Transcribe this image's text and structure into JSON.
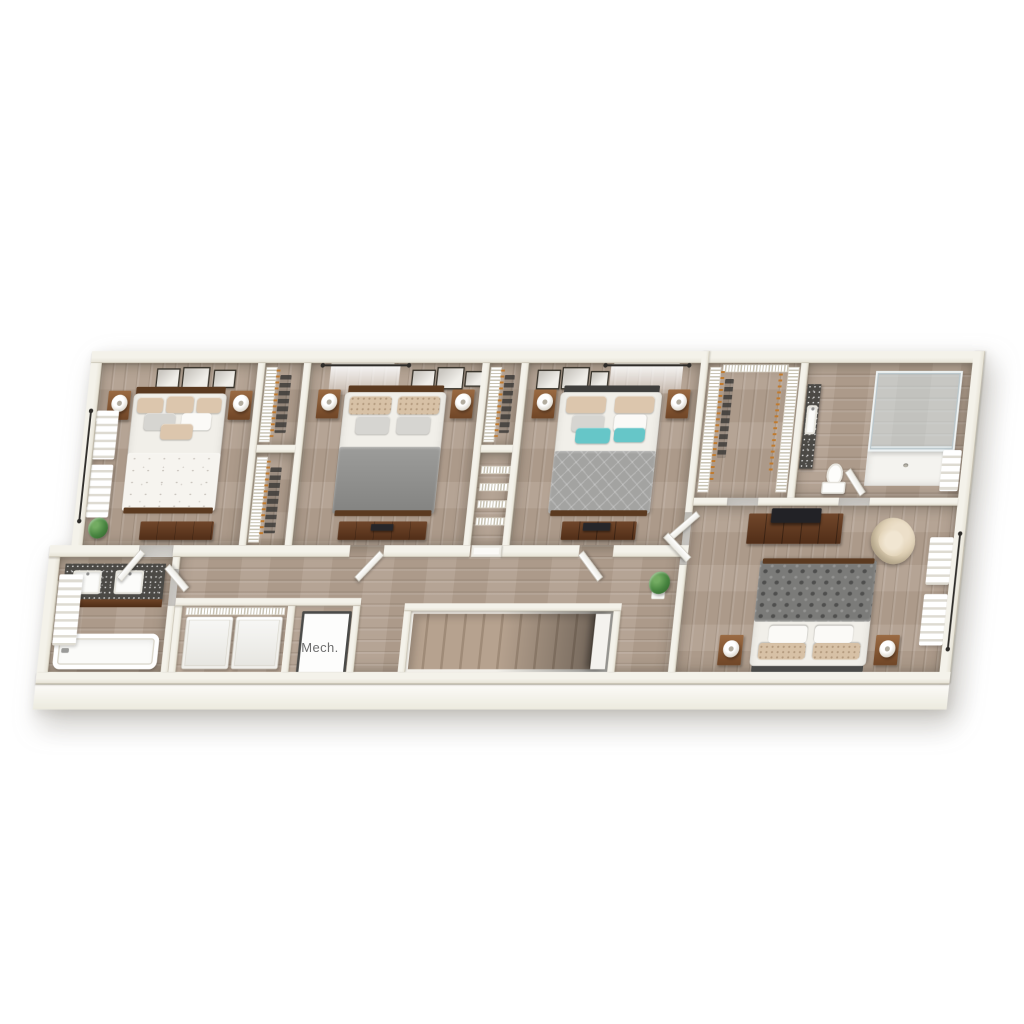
{
  "scene": {
    "type": "3d-floorplan-render",
    "view": "tilted top-down dollhouse",
    "background": "#ffffff"
  },
  "labels": {
    "mech": "Mech."
  },
  "palette": {
    "wall_top": "#f4f2ea",
    "wall": "#e6e2d5",
    "wall_edge": "#c8c2b2",
    "floor": "#b19f8f",
    "wood_dark": "#5b3a20",
    "wood_mid": "#8a5a36",
    "granite": "#4b4945",
    "teal": "#66c6c8",
    "gray_blanket": "#909090",
    "appliance": "#f6f6f3",
    "glass": "#d9e6ea",
    "hanger": "#c07a2e",
    "plant": "#47833f",
    "label": "#6e6e6e"
  },
  "rooms": [
    {
      "name": "bedroom-1",
      "furniture": [
        "bed-floral",
        "nightstand",
        "nightstand",
        "table-lamp",
        "table-lamp",
        "dresser",
        "gallery-frames",
        "window",
        "curtains",
        "potted-plant"
      ]
    },
    {
      "name": "closet-a-upper",
      "furniture": [
        "wire-shelving",
        "clothes-hangers",
        "hanging-clothes"
      ]
    },
    {
      "name": "closet-a-lower",
      "furniture": [
        "wire-shelving",
        "clothes-hangers",
        "hanging-clothes"
      ]
    },
    {
      "name": "bedroom-2",
      "furniture": [
        "bed-gray",
        "nightstand",
        "nightstand",
        "table-lamp",
        "table-lamp",
        "dresser",
        "gallery-frames",
        "window",
        "sheer-curtain",
        "curtain-rod"
      ]
    },
    {
      "name": "closet-b-upper",
      "furniture": [
        "wire-shelving",
        "clothes-hangers",
        "hanging-clothes"
      ]
    },
    {
      "name": "linen-closet",
      "furniture": [
        "wire-shelves",
        "door"
      ]
    },
    {
      "name": "bedroom-3",
      "furniture": [
        "bed-teal-pillows",
        "nightstand",
        "nightstand",
        "table-lamp",
        "table-lamp",
        "dresser",
        "gallery-frames",
        "window",
        "sheer-curtain",
        "curtain-rod"
      ]
    },
    {
      "name": "walk-in-closet",
      "furniture": [
        "wire-shelving",
        "clothes-hangers",
        "hanging-clothes"
      ]
    },
    {
      "name": "master-bathroom",
      "furniture": [
        "glass-shower",
        "shower-floor-drain",
        "toilet",
        "vanity",
        "sink",
        "window",
        "blinds"
      ]
    },
    {
      "name": "master-bedroom",
      "furniture": [
        "bed-patterned",
        "nightstand",
        "nightstand",
        "table-lamp",
        "table-lamp",
        "dresser",
        "tv",
        "accent-chair",
        "window",
        "curtains",
        "double-doors"
      ]
    },
    {
      "name": "hall-bathroom",
      "furniture": [
        "double-vanity",
        "sink",
        "sink",
        "bathtub",
        "window",
        "curtain",
        "door"
      ]
    },
    {
      "name": "laundry-closet",
      "furniture": [
        "washer",
        "dryer",
        "wire-shelf"
      ]
    },
    {
      "name": "mechanical-closet",
      "label_ref": "labels.mech",
      "furniture": [
        "mechanical-unit"
      ]
    },
    {
      "name": "hallway",
      "furniture": [
        "staircase-opening",
        "potted-plant",
        "doors"
      ]
    }
  ]
}
